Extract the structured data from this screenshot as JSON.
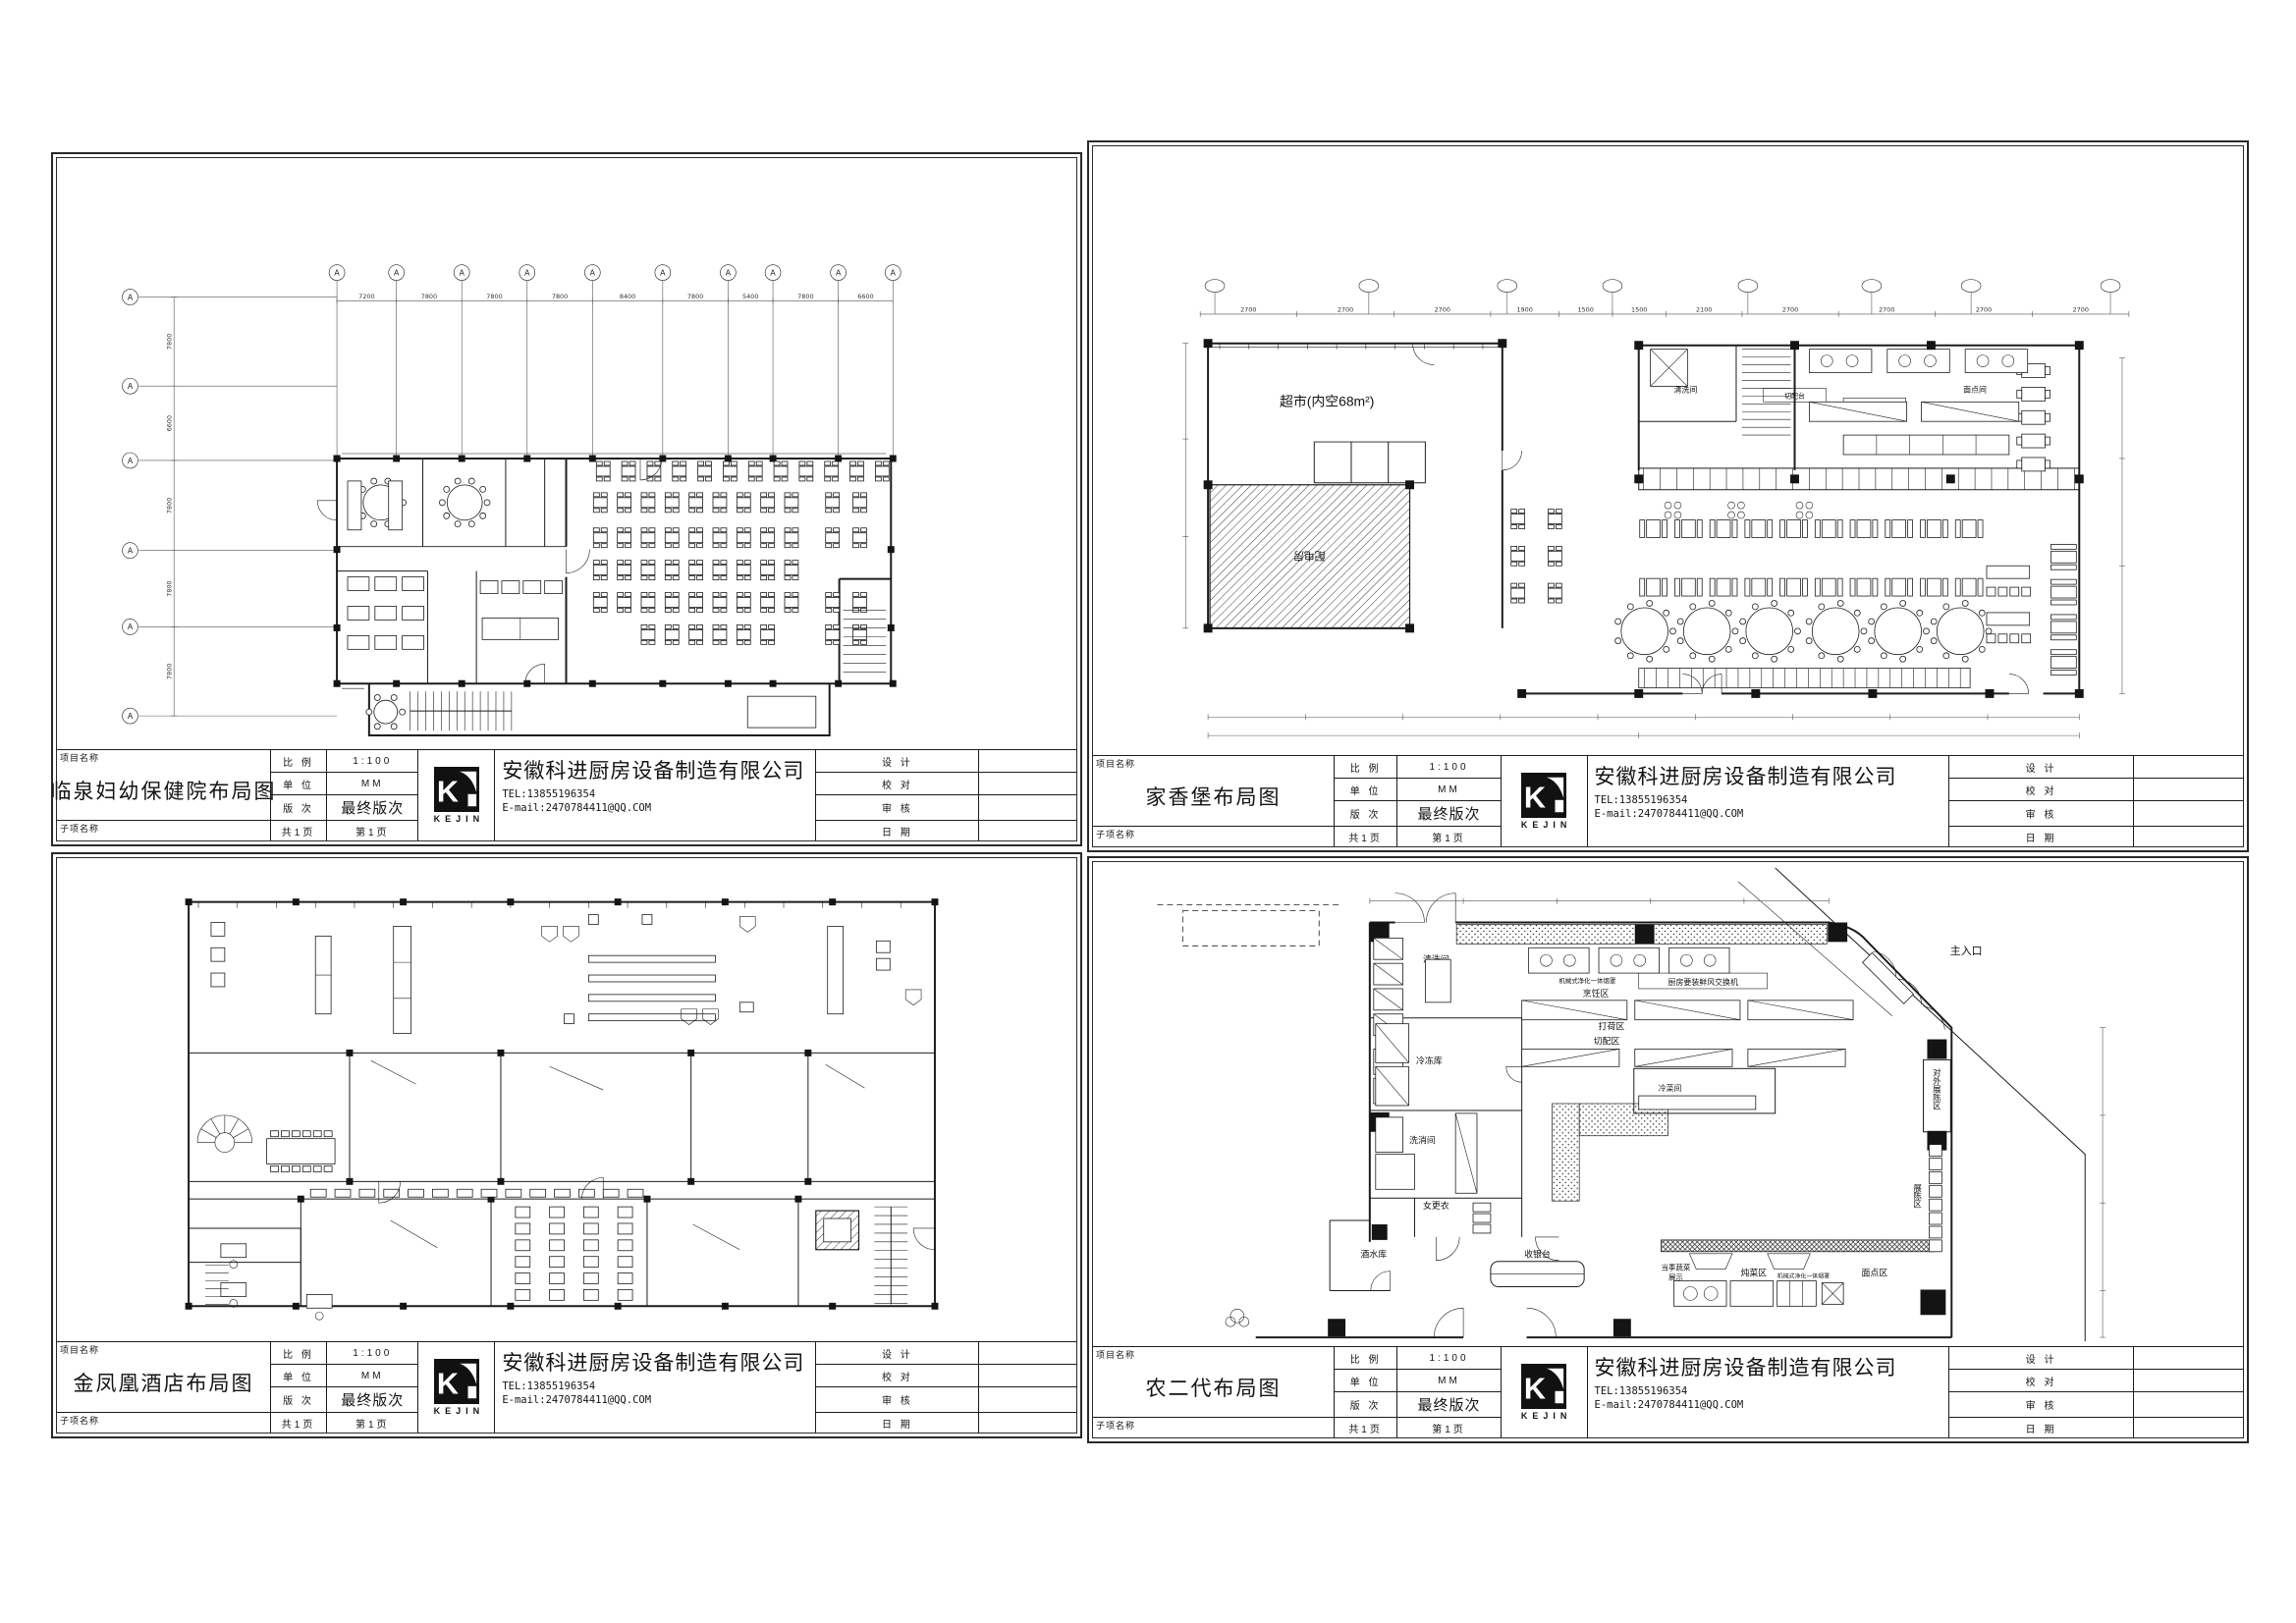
{
  "page": {
    "background": "#ffffff",
    "line_color": "#1c1c1c"
  },
  "titleblock": {
    "labels": {
      "project_name": "项目名称",
      "sub_project_name": "子项名称",
      "scale": "比 例",
      "unit": "单 位",
      "revision": "版 次",
      "total_pages": "共1页",
      "design": "设 计",
      "proofread": "校 对",
      "review": "审 核",
      "date": "日 期"
    },
    "values": {
      "scale": "1:100",
      "unit": "MM",
      "revision": "最终版次",
      "page_no": "第1页"
    },
    "company": {
      "name": "安徽科进厨房设备制造有限公司",
      "tel": "TEL:13855196354",
      "email": "E-mail:2470784411@QQ.COM",
      "logo_text": "KEJIN"
    }
  },
  "sheets": [
    {
      "project_title": "临泉妇幼保健院布局图"
    },
    {
      "project_title": "家香堡布局图"
    },
    {
      "project_title": "金凤凰酒店布局图"
    },
    {
      "project_title": "农二代布局图"
    }
  ],
  "plans": {
    "hospital": {
      "grid_bubble": "A",
      "top_dims": [
        "7200",
        "7800",
        "7800",
        "7800",
        "8400",
        "7800",
        "5400",
        "7800",
        "6600"
      ],
      "left_dims": [
        "7800",
        "6600",
        "7800",
        "7800",
        "7800"
      ]
    },
    "jiaxiangbao": {
      "supermarket": "超市(内空68m²)",
      "power_room": "配电房",
      "top_dims": [
        "2700",
        "2700",
        "2700",
        "1900",
        "1500",
        "1500",
        "2100",
        "2700",
        "2700",
        "2700",
        "2700"
      ],
      "labels": {
        "qingxi": "清洗间",
        "qiepei": "切配台",
        "dahe": "打荷台",
        "miandian": "面点间"
      }
    },
    "jinfenghuang": {},
    "nongerdai": {
      "rooms": {
        "qingxijian": "清洗间",
        "lengdongku": "冷冻库",
        "xixiaojian": "洗消间",
        "nvgengyi": "女更衣",
        "jiushuiku": "酒水库",
        "shouyintai": "收银台",
        "pengrenqu": "烹饪区",
        "daheq": "打荷区",
        "qiepeiqu": "切配区",
        "lengcaijian": "冷菜间",
        "duncaiqu": "炖菜区",
        "miandianqu": "面点区",
        "zhurukou": "主入口",
        "duiwaizhanchenqu": "对外展陈区",
        "zhanchenqu": "展陈区"
      },
      "notes": {
        "fresh_air": "厨房要装鲜风交换机",
        "hood": "机械式净化一体烟罩",
        "veg_line1": "当季蔬菜",
        "veg_line2": "展示"
      }
    }
  }
}
